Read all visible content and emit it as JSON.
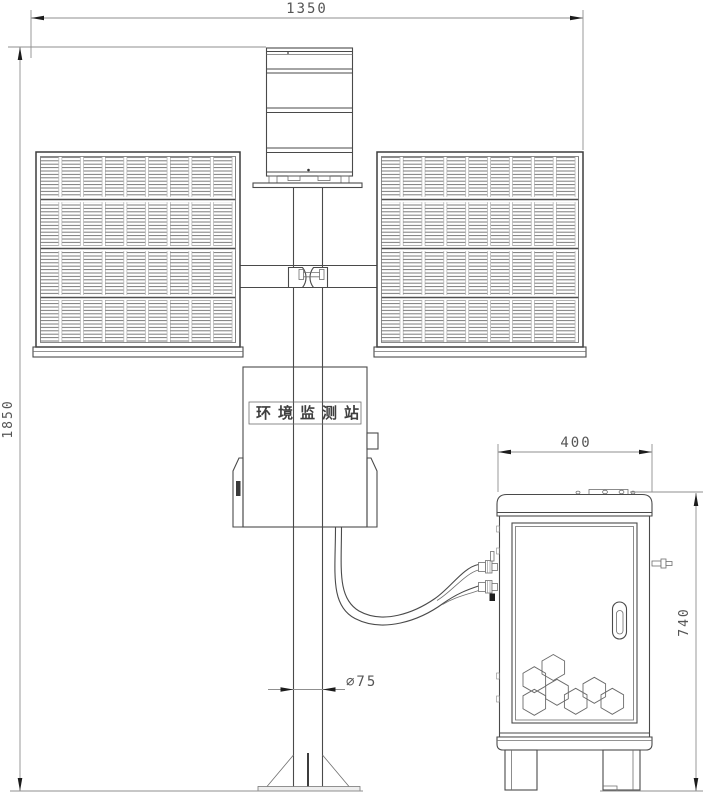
{
  "colors": {
    "background": "#ffffff",
    "line": "#4a4a4a",
    "dim_line": "#8f8f8f",
    "arrow": "#1c1c1c",
    "text": "#555555",
    "label_text": "#3f3f3f"
  },
  "station_label": {
    "text": "环境监测站"
  },
  "dimensions": {
    "overall_width": "1350",
    "overall_height": "1850",
    "cabinet_width": "400",
    "cabinet_height": "740",
    "pole_diameter": "∅75"
  }
}
